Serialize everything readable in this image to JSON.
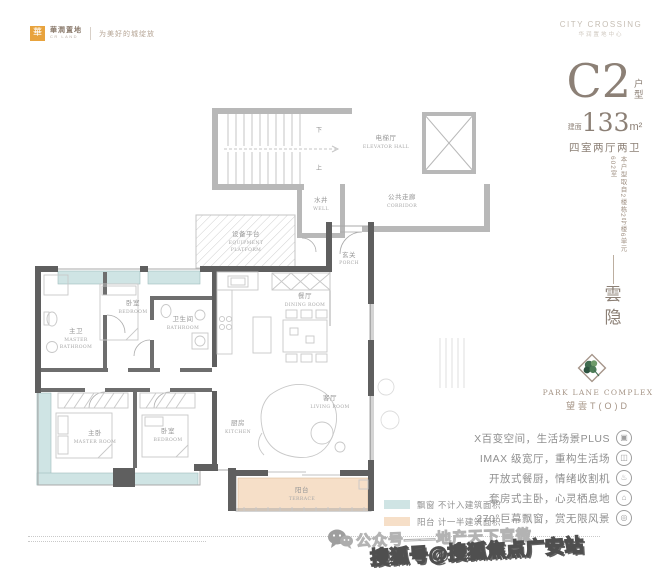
{
  "header": {
    "brand": {
      "mark": "華",
      "name_cn": "華潤置地",
      "name_en": "CR LAND",
      "slogan": "为美好的城绽放"
    },
    "project": {
      "name_en": "CITY CROSSING",
      "name_cn": "华润置地中心"
    }
  },
  "unit_info": {
    "unit_code": "C2",
    "unit_suffix_1": "户",
    "unit_suffix_2": "型",
    "area_prefix": "建面",
    "area_value": "133",
    "area_unit": "m²",
    "layout": "四室两厅两卫",
    "source_note": "本户型取自2楼栋2号楼6单元602室",
    "theme_char_1": "雲",
    "theme_char_2": "隐"
  },
  "branding": {
    "complex_en": "PARK LANE COMPLEX",
    "complex_cn": "望雲T(O)D"
  },
  "selling_points": [
    {
      "text": "X百变空间，生活场景PLUS",
      "icon": "cube-icon",
      "glyph": "▣"
    },
    {
      "text": "IMAX 级宽厅，重构生活场",
      "icon": "screen-icon",
      "glyph": "◫"
    },
    {
      "text": "开放式餐厨，情绪收割机",
      "icon": "dining-icon",
      "glyph": "♨"
    },
    {
      "text": "套房式主卧，心灵栖息地",
      "icon": "bed-icon",
      "glyph": "⌂"
    },
    {
      "text": "270°巨幕飘窗，赏无限风景",
      "icon": "window-icon",
      "glyph": "◎"
    }
  ],
  "legend": [
    {
      "label": "飘窗 不计入建筑面积",
      "swatch_color": "#cfe4e4"
    },
    {
      "label": "阳台 计一半建筑面积",
      "swatch_color": "#f6dfc8"
    }
  ],
  "floorplan": {
    "rooms": {
      "elevator_hall": {
        "cn": "电梯厅",
        "en": "ELEVATOR HALL"
      },
      "corridor": {
        "cn": "公共走廊",
        "en": "CORRIDOR"
      },
      "well": {
        "cn": "水井",
        "en": "WELL"
      },
      "equipment_platform": {
        "cn": "设备平台",
        "en1": "EQUIPMENT",
        "en2": "PLATFORM"
      },
      "porch": {
        "cn": "玄关",
        "en": "PORCH"
      },
      "kitchen": {
        "cn": "厨房",
        "en": "KITCHEN"
      },
      "dining": {
        "cn": "餐厅",
        "en": "DINING ROOM"
      },
      "living": {
        "cn": "客厅",
        "en": "LIVING ROOM"
      },
      "master_bath": {
        "cn": "主卫",
        "en1": "MASTER",
        "en2": "BATHROOM"
      },
      "bedroom_north": {
        "cn": "卧室",
        "en": "BEDROOM"
      },
      "bath": {
        "cn": "卫生间",
        "en": "BATHROOM"
      },
      "master_room": {
        "cn": "主卧",
        "en": "MASTER ROOM"
      },
      "bedroom_south": {
        "cn": "卧室",
        "en": "BEDROOM"
      },
      "terrace": {
        "cn": "阳台",
        "en": "TERRACE"
      },
      "stair_up": "上",
      "stair_down": "下"
    },
    "colors": {
      "bay_window_fill": "#cfe4e4",
      "terrace_fill": "#f6dfc8",
      "unit_wall": "#5f5f5f",
      "common_wall": "#b8b8b8"
    }
  },
  "watermark": {
    "wechat_account": "公众号——地产天下官微",
    "sohu_account": "搜狐号@搜狐焦点广安站"
  },
  "accent_color": "#8c8076",
  "logo_green": "#3f6b4f"
}
